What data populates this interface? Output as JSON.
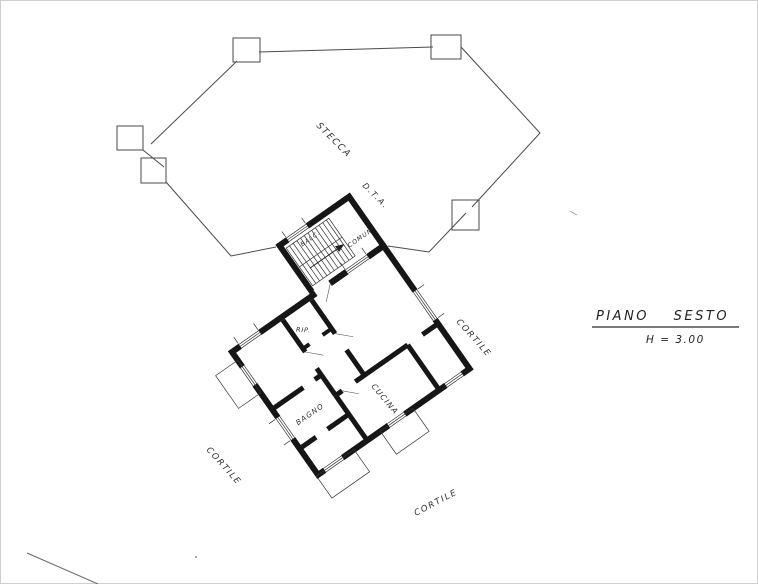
{
  "drawing": {
    "type": "architectural floor plan (scanned hand-drawn)",
    "title_block": {
      "title": "PIANO SESTO",
      "height_label": "H = 3.00"
    },
    "outline": {
      "terrace_label": "STECCA",
      "annotation": "D.T.A."
    },
    "courtyard_labels": [
      "CORTILE",
      "CORTILE",
      "CORTILE"
    ],
    "rooms": {
      "kitchen": "CUCINA",
      "bathroom": "BAGNO",
      "storage": "RIP.",
      "stair_common": "COMUN.",
      "balcony": "BALC."
    },
    "colors": {
      "paper": "#ffffff",
      "ink": "#161616",
      "outline_line": "#4a4a4a",
      "frame": "#cfcfcf"
    }
  }
}
